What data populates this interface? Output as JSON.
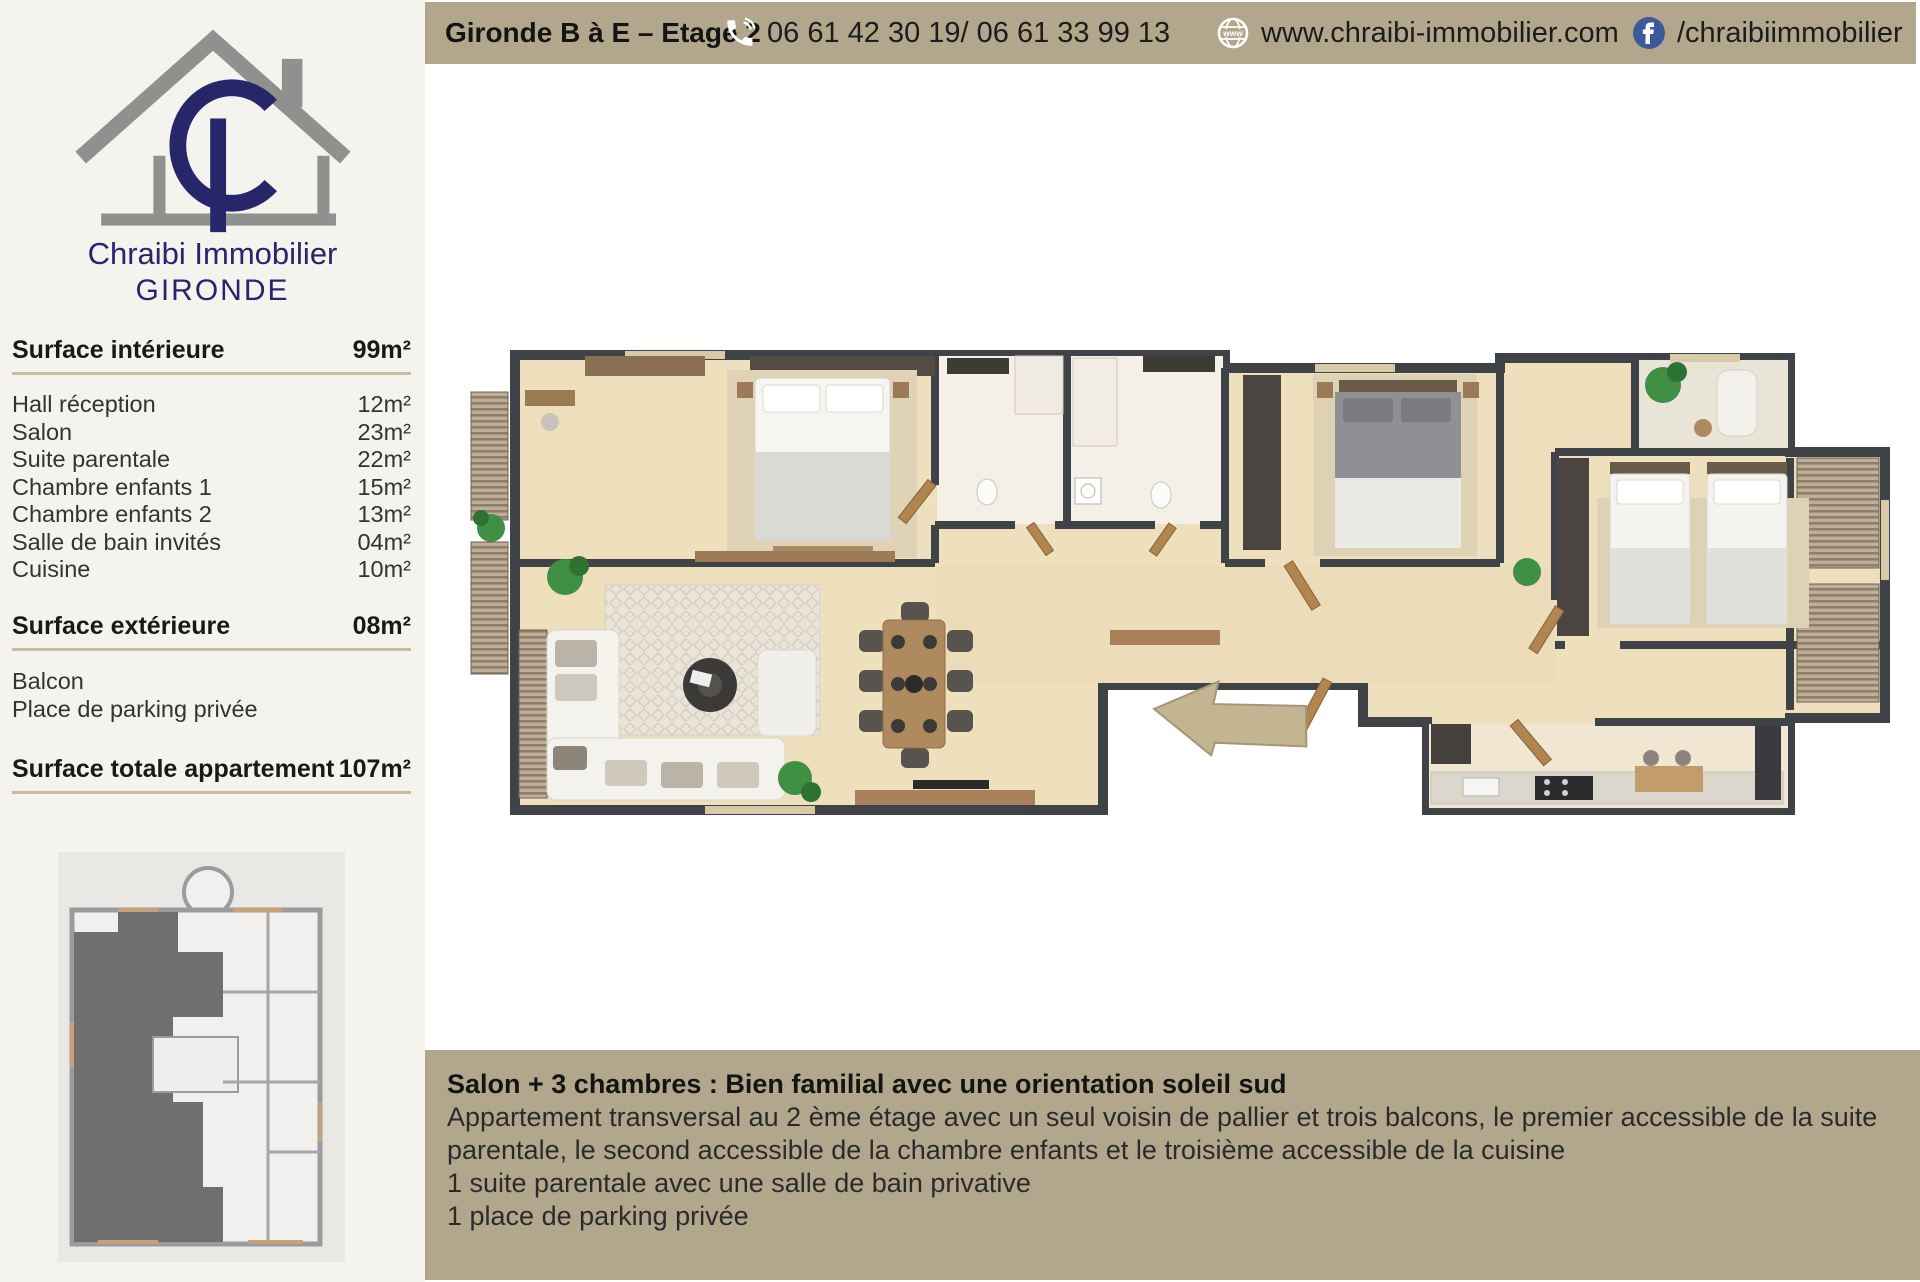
{
  "brand": {
    "monogram": "CI",
    "name": "Chraibi Immobilier",
    "region": "GIRONDE",
    "navy": "#27266b",
    "gray": "#90908f"
  },
  "header": {
    "title": "Gironde B à E – Etage 2",
    "phone": "06 61 42 30 19/ 06 61 33 99 13",
    "website": "www.chraibi-immobilier.com",
    "facebook": "/chraibiimmobilier",
    "bar_color": "#b2a78c",
    "facebook_blue": "#3c5a99",
    "icons": [
      "phone-icon",
      "globe-www-icon",
      "facebook-icon"
    ]
  },
  "surfaces": {
    "interior": {
      "label": "Surface intérieure",
      "value": "99m²",
      "rooms": [
        {
          "label": "Hall réception",
          "value": "12m²"
        },
        {
          "label": "Salon",
          "value": "23m²"
        },
        {
          "label": "Suite parentale",
          "value": "22m²"
        },
        {
          "label": "Chambre enfants 1",
          "value": "15m²"
        },
        {
          "label": "Chambre enfants 2",
          "value": "13m²"
        },
        {
          "label": "Salle de bain invités",
          "value": "04m²"
        },
        {
          "label": "Cuisine",
          "value": "10m²"
        }
      ]
    },
    "exterior": {
      "label": "Surface extérieure",
      "value": "08m²",
      "items": [
        {
          "label": "Balcon"
        },
        {
          "label": "Place de parking privée"
        }
      ]
    },
    "total": {
      "label": "Surface totale appartement",
      "value": "107m²"
    },
    "underline_color": "#c8bc9d"
  },
  "description": {
    "title": "Salon + 3 chambres : Bien familial avec une orientation soleil sud",
    "lines": [
      "Appartement transversal au 2 ème étage avec un seul voisin de pallier et trois balcons, le premier accessible de la suite",
      "parentale, le second accessible de la chambre enfants et le troisième accessible de la cuisine",
      "1 suite parentale avec une salle de bain privative",
      "1 place de parking privée"
    ]
  }
}
